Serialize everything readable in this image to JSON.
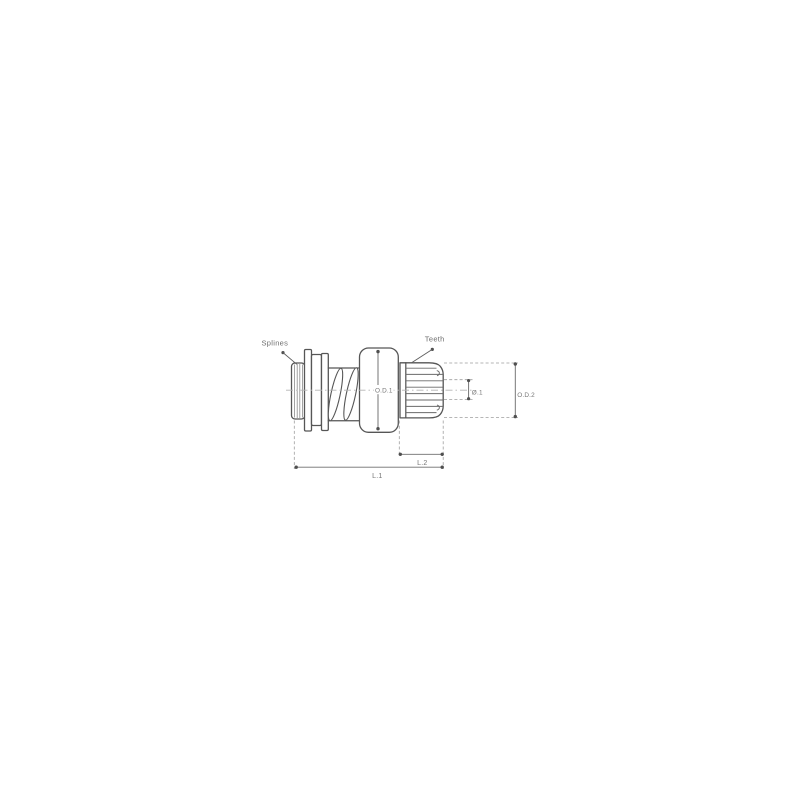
{
  "page": {
    "background_color": "#ffffff",
    "content": "technical dimensional drawing of a starter motor drive pinion (bendix gear)"
  },
  "diagram": {
    "colors": {
      "part_outline": "#565656",
      "dimension_line": "#6f6f6f",
      "extension_line": "#9e9e9e",
      "centerline": "#b3b3b3",
      "label_text": "#6e6e6e"
    },
    "labels": {
      "splines": "Splines",
      "teeth": "Teeth",
      "od1": "O.D.1",
      "id1": "Ø.1",
      "od2": "O.D.2",
      "l2": "L.2",
      "l1": "L.1"
    }
  }
}
